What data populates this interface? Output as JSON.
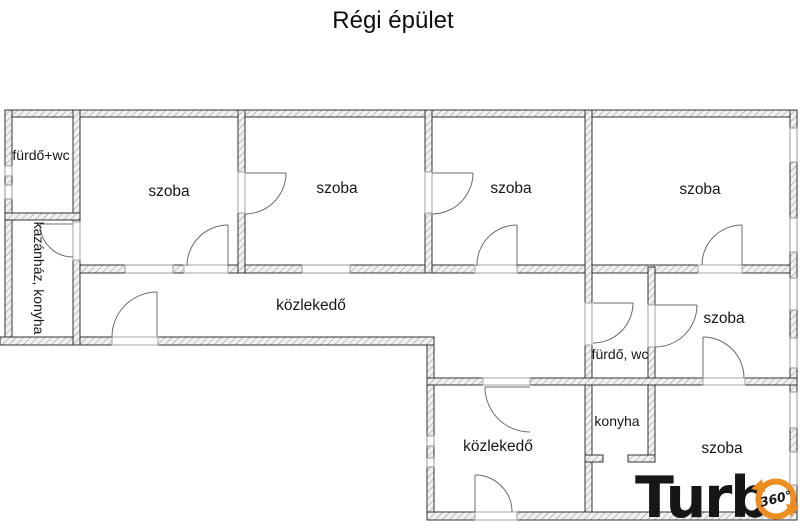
{
  "title": "Régi épület",
  "rooms": {
    "bath_top": "fürdő+wc",
    "boiler_kitchen": "kazánház, konyha",
    "szoba1": "szoba",
    "szoba2": "szoba",
    "szoba3": "szoba",
    "szoba4": "szoba",
    "corridor_upper": "közlekedő",
    "bath_mid": "fürdő, wc",
    "szoba_mid": "szoba",
    "kitchen": "konyha",
    "corridor_lower": "közlekedő",
    "szoba_bottom": "szoba"
  },
  "logo": {
    "wordmark": "Turb",
    "badge": "360°"
  },
  "colors": {
    "wall_outline": "#333333",
    "wall_fill": "#f1f1f1",
    "hatch_line": "#8f8f8f",
    "thin_line": "#999999",
    "door_line": "#6b6b6b",
    "logo_orange": "#ee8d1f",
    "logo_blue": "#2356a8",
    "logo_navy": "#1d3e7a"
  }
}
